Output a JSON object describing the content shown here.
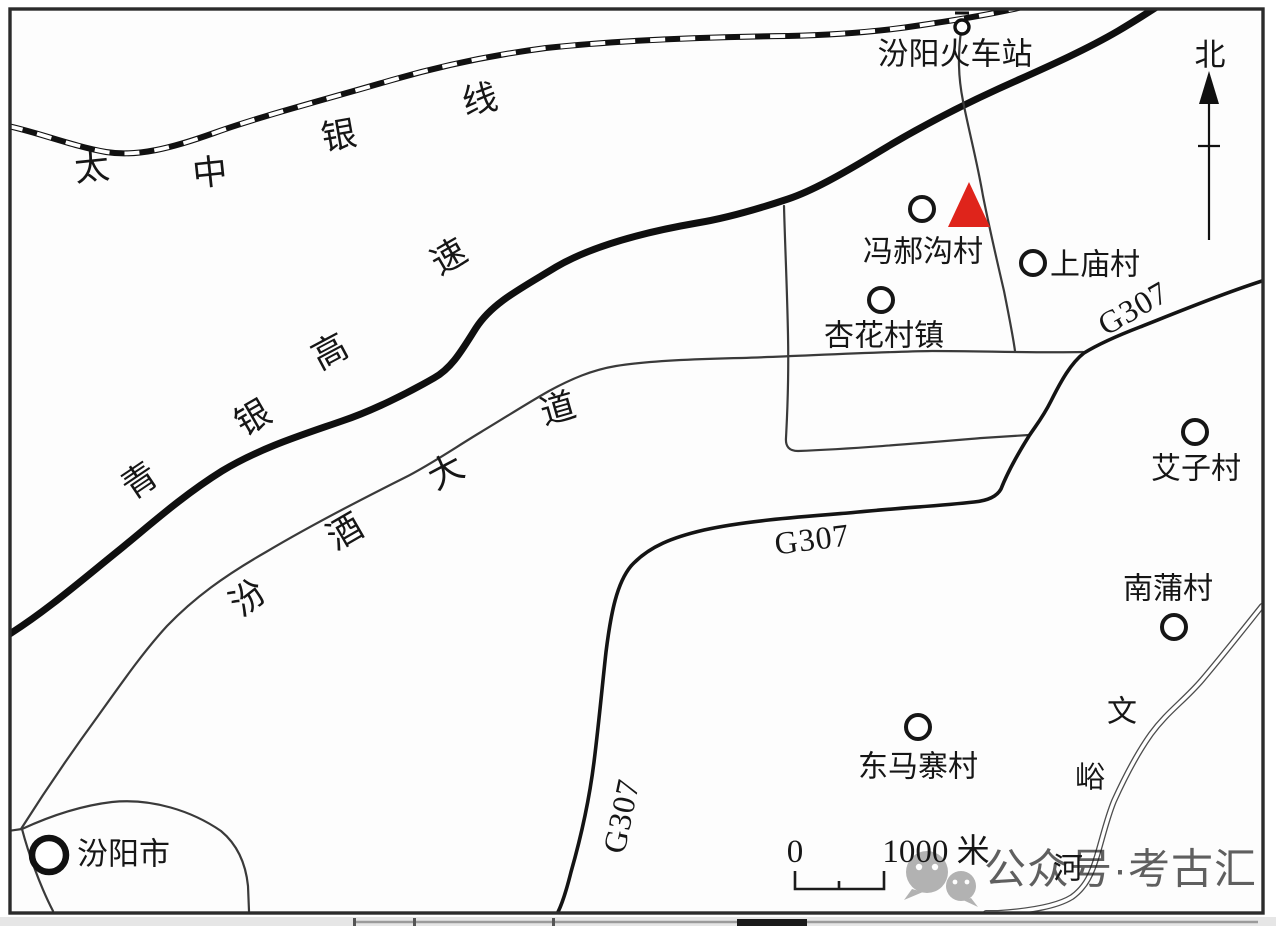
{
  "north": {
    "label": "北"
  },
  "railway": {
    "name": "太中银线",
    "chars": [
      "太",
      "中",
      "银",
      "线"
    ]
  },
  "expressway": {
    "name": "青银高速",
    "chars": [
      "青",
      "银",
      "高",
      "速"
    ]
  },
  "avenue": {
    "name": "汾酒大道",
    "chars": [
      "汾",
      "酒",
      "大",
      "道"
    ]
  },
  "g307": {
    "label": "G307"
  },
  "river": {
    "name": "文峪河",
    "chars": [
      "文",
      "峪",
      "河"
    ]
  },
  "station": {
    "name": "汾阳火车站"
  },
  "villages": [
    {
      "name": "冯郝沟村",
      "marker": "circle-with-red-site-triangle"
    },
    {
      "name": "上庙村",
      "marker": "circle"
    },
    {
      "name": "杏花村镇",
      "marker": "circle"
    },
    {
      "name": "艾子村",
      "marker": "circle"
    },
    {
      "name": "南蒲村",
      "marker": "circle"
    },
    {
      "name": "东马寨村",
      "marker": "circle"
    },
    {
      "name": "汾阳市",
      "marker": "bold-circle"
    }
  ],
  "scalebar": {
    "zero": "0",
    "label": "1000 米"
  },
  "watermark": {
    "text": "公众号·考古汇"
  },
  "colors": {
    "site_marker": "#df241b",
    "line": "#161616",
    "watermark": "#b2b2b2"
  }
}
